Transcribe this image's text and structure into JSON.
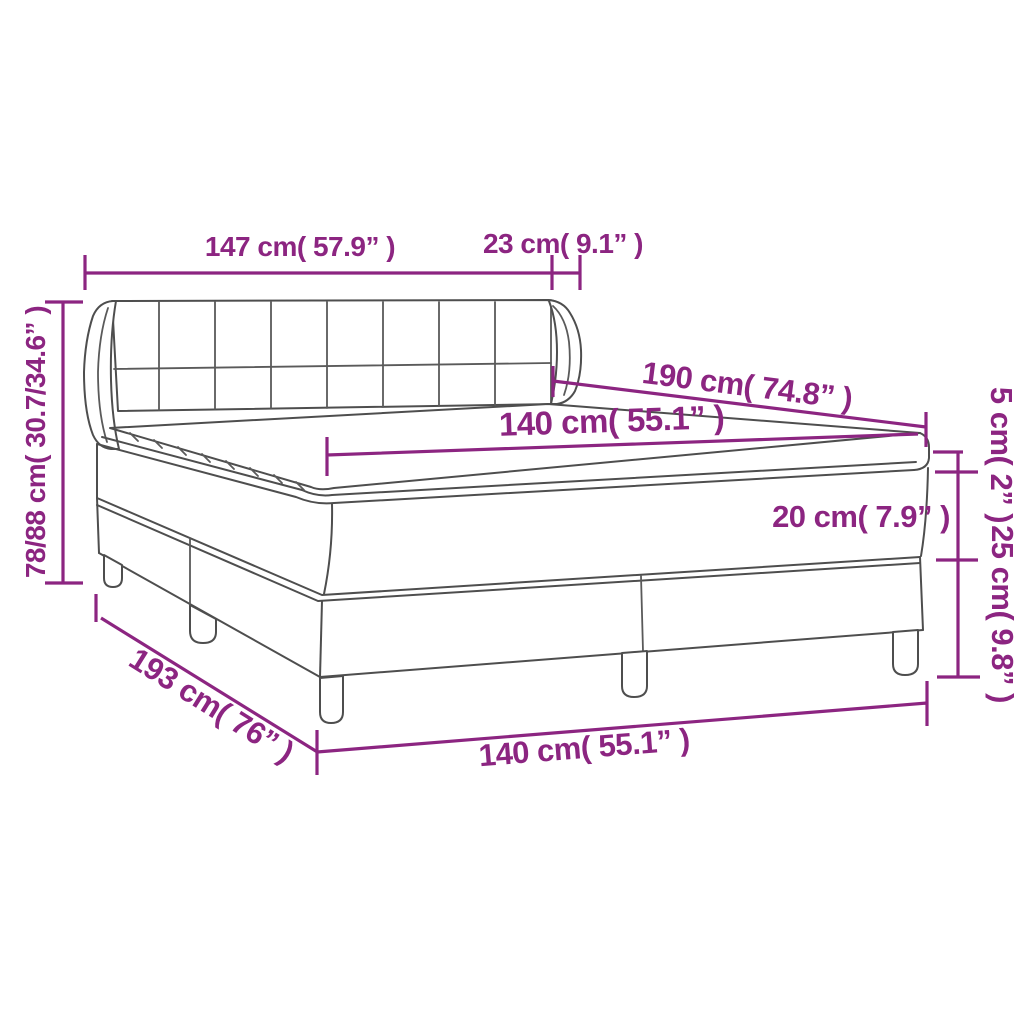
{
  "diagram": {
    "kind": "product-dimension-diagram",
    "subject": "box spring bed with tufted winged headboard, mattress and topper",
    "accent_color": "#8C2581",
    "outline_color": "#4E4E4E",
    "background_color": "#FFFFFF"
  },
  "measurements": {
    "headboard_width": "147 cm( 57.9” )",
    "headboard_side_depth": "23 cm( 9.1” )",
    "total_height_range": "78/88 cm( 30.7/34.6” )",
    "bed_length": "190 cm( 74.8” )",
    "mattress_width": "140 cm( 55.1” )",
    "topper_thickness": "5 cm( 2” )",
    "mattress_thickness": "20 cm( 7.9” )",
    "base_height": "25 cm( 9.8” )",
    "frame_diagonal_length": "193 cm( 76” )",
    "frame_width": "140 cm( 55.1” )"
  }
}
